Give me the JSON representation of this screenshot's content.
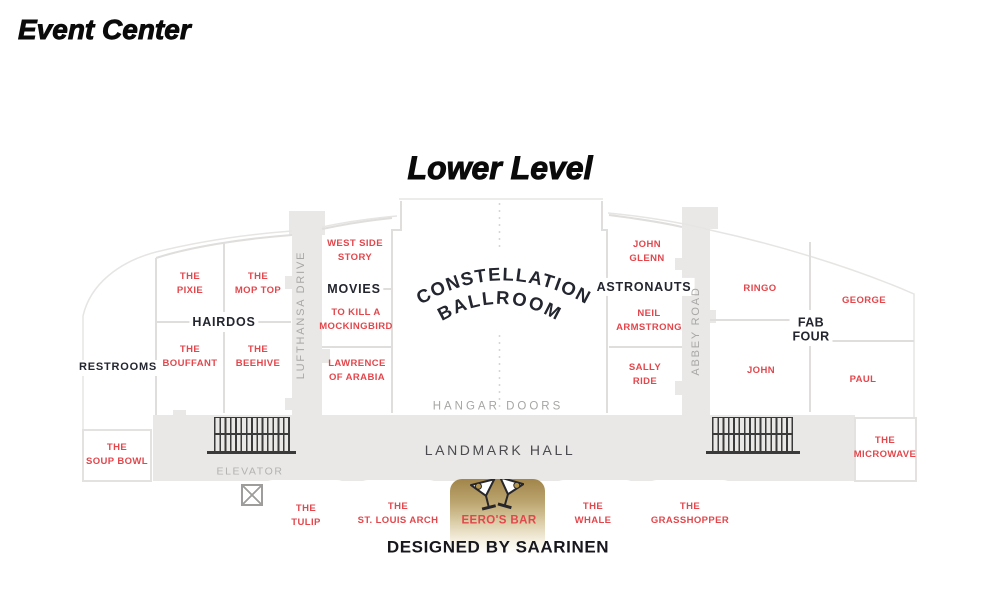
{
  "header": {
    "title": "Event Center",
    "level_title": "Lower Level"
  },
  "map": {
    "groups": {
      "hairdos": "HAIRDOS",
      "movies": "MOVIES",
      "astronauts": "ASTRONAUTS",
      "fab_four": "FAB\nFOUR"
    },
    "rooms": {
      "restrooms": "RESTROOMS",
      "pixie": "THE\nPIXIE",
      "mop_top": "THE\nMOP TOP",
      "bouffant": "THE\nBOUFFANT",
      "beehive": "THE\nBEEHIVE",
      "west_side_story": "WEST SIDE\nSTORY",
      "to_kill_a_mockingbird": "TO KILL A\nMOCKINGBIRD",
      "lawrence_of_arabia": "LAWRENCE\nOF ARABIA",
      "john_glenn": "JOHN\nGLENN",
      "neil_armstrong": "NEIL\nARMSTRONG",
      "sally_ride": "SALLY\nRIDE",
      "ringo": "RINGO",
      "george": "GEORGE",
      "john": "JOHN",
      "paul": "PAUL",
      "soup_bowl": "THE\nSOUP BOWL",
      "microwave": "THE\nMICROWAVE",
      "tulip": "THE\nTULIP",
      "st_louis_arch": "THE\nST. LOUIS ARCH",
      "eeros_bar": "EERO'S BAR",
      "whale": "THE\nWHALE",
      "grasshopper": "THE\nGRASSHOPPER"
    },
    "ballroom": {
      "line1": "CONSTELLATION",
      "line2": "BALLROOM"
    },
    "corridors": {
      "lufthansa_drive": "LUFTHANSA DRIVE",
      "abbey_road": "ABBEY ROAD"
    },
    "areas": {
      "hangar_doors": "HANGAR DOORS",
      "landmark_hall": "LANDMARK HALL",
      "elevator": "ELEVATOR"
    },
    "footer_note": "DESIGNED BY SAARINEN",
    "colors": {
      "room_label": "#e2474c",
      "group_label": "#23252f",
      "corridor_fill": "#e9e8e6",
      "wall_line": "#dfdedc",
      "muted_label": "#a8a7a5",
      "eeros_gold": "#a1854a",
      "stairs_ink": "#3a3a3a"
    }
  }
}
